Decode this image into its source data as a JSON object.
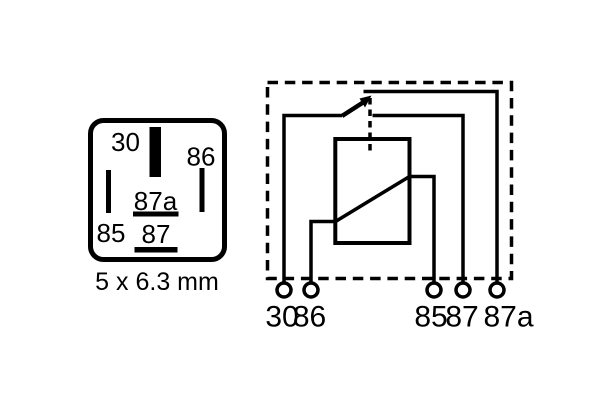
{
  "colors": {
    "ink": "#000000",
    "background": "#ffffff"
  },
  "pinout_box": {
    "pin_30_label": "30",
    "pin_86_label": "86",
    "pin_85_label": "85",
    "pin_87a_label": "87a",
    "pin_87_label": "87",
    "caption": "5 x 6.3 mm"
  },
  "schematic": {
    "terminals": [
      {
        "label": "30"
      },
      {
        "label": "86"
      },
      {
        "label": "85"
      },
      {
        "label": "87"
      },
      {
        "label": "87a"
      }
    ]
  }
}
